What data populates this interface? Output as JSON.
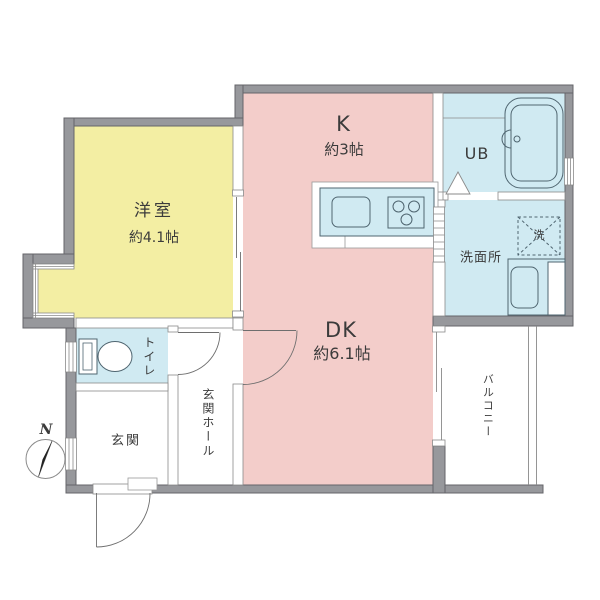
{
  "document": {
    "type": "floor-plan"
  },
  "rooms": {
    "yoshitsu": {
      "name": "洋室",
      "size": "約4.1帖"
    },
    "k": {
      "name": "K",
      "size": "約3帖"
    },
    "dk": {
      "name": "DK",
      "size": "約6.1帖"
    },
    "ub": {
      "name": "UB"
    },
    "senmenjo": {
      "name": "洗面所"
    },
    "toilet": {
      "name": "トイレ"
    },
    "genkan": {
      "name": "玄関"
    },
    "genkan_hall": {
      "name": "玄関ホール"
    },
    "balcony": {
      "name": "バルコニー"
    }
  },
  "fixtures": {
    "washer": {
      "name": "洗"
    }
  },
  "compass": {
    "north": "N"
  },
  "colors": {
    "room_yellow": "#f3eea3",
    "room_pink": "#f3cdca",
    "room_cyan": "#d0eaf2",
    "wall_gray": "#97989c",
    "wall_outline": "#64656a",
    "fixture_line": "#4f6570",
    "text": "#3b3b3b"
  }
}
